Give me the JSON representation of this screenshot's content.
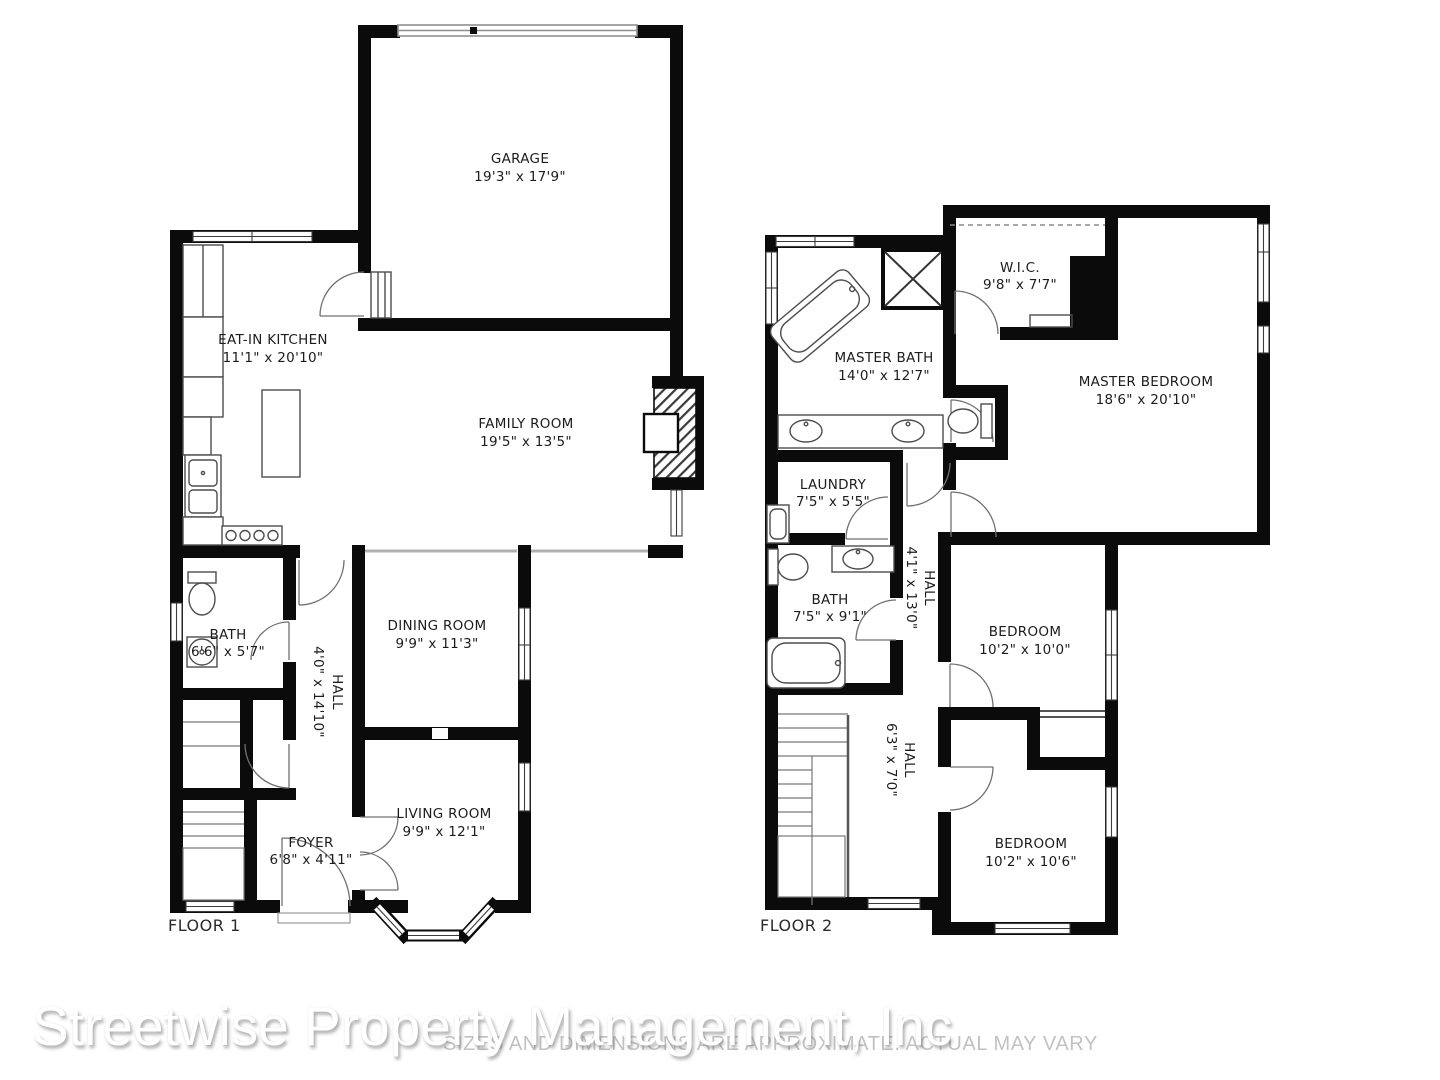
{
  "watermark": {
    "company": "Streetwise Property Management, Inc",
    "disclaimer": "SIZES AND DIMENSIONS ARE APPROXIMATE. ACTUAL MAY VARY"
  },
  "colors": {
    "wall": "#0b0b0b",
    "label_text": "#1c1c1c",
    "background": "#ffffff",
    "watermark_shadow": "#7d7d7d"
  },
  "floor1": {
    "label": "FLOOR 1",
    "rooms": {
      "garage": {
        "name": "GARAGE",
        "dims": "19'3\" x 17'9\""
      },
      "kitchen": {
        "name": "EAT-IN KITCHEN",
        "dims": "11'1\" x 20'10\""
      },
      "family": {
        "name": "FAMILY ROOM",
        "dims": "19'5\" x 13'5\""
      },
      "bath": {
        "name": "BATH",
        "dims": "6'6\" x 5'7\""
      },
      "dining": {
        "name": "DINING ROOM",
        "dims": "9'9\" x 11'3\""
      },
      "hall": {
        "name": "HALL",
        "dims": "4'0\" x 14'10\""
      },
      "living": {
        "name": "LIVING ROOM",
        "dims": "9'9\" x 12'1\""
      },
      "foyer": {
        "name": "FOYER",
        "dims": "6'8\" x 4'11\""
      }
    }
  },
  "floor2": {
    "label": "FLOOR 2",
    "rooms": {
      "master_bath": {
        "name": "MASTER BATH",
        "dims": "14'0\" x 12'7\""
      },
      "wic": {
        "name": "W.I.C.",
        "dims": "9'8\" x 7'7\""
      },
      "master_bedroom": {
        "name": "MASTER BEDROOM",
        "dims": "18'6\" x 20'10\""
      },
      "laundry": {
        "name": "LAUNDRY",
        "dims": "7'5\" x 5'5\""
      },
      "bath": {
        "name": "BATH",
        "dims": "7'5\" x 9'1\""
      },
      "hall_upper": {
        "name": "HALL",
        "dims": "4'1\" x 13'0\""
      },
      "bedroom_front": {
        "name": "BEDROOM",
        "dims": "10'2\" x 10'0\""
      },
      "hall_lower": {
        "name": "HALL",
        "dims": "6'3\" x 7'0\""
      },
      "bedroom_rear": {
        "name": "BEDROOM",
        "dims": "10'2\" x 10'6\""
      }
    }
  }
}
